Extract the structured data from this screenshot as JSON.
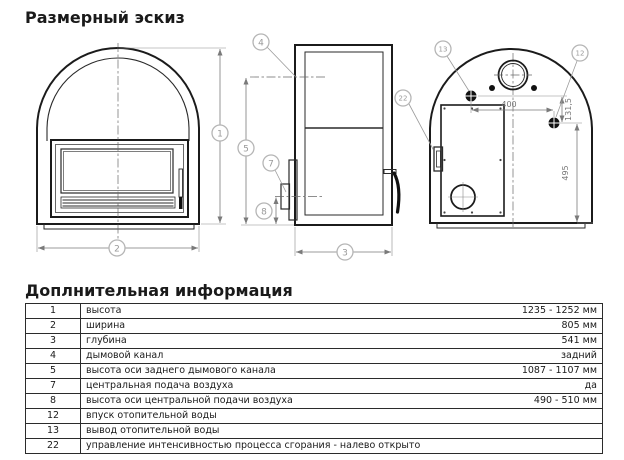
{
  "page": {
    "title": "Размерный эскиз"
  },
  "drawing": {
    "callouts": {
      "c1": "1",
      "c2": "2",
      "c3": "3",
      "c4": "4",
      "c5": "5",
      "c7": "7",
      "c8": "8",
      "c12": "12",
      "c13": "13",
      "c22": "22"
    },
    "dimensions": {
      "rear_horizontal": "400",
      "rear_offset": "131,5",
      "rear_height": "495"
    }
  },
  "info": {
    "heading": "Доплнительная информация",
    "rows": [
      {
        "num": "1",
        "desc": "высота",
        "value": "1235 - 1252 мм"
      },
      {
        "num": "2",
        "desc": "ширина",
        "value": "805 мм"
      },
      {
        "num": "3",
        "desc": "глубина",
        "value": "541 мм"
      },
      {
        "num": "4",
        "desc": "дымовой канал",
        "value": "задний"
      },
      {
        "num": "5",
        "desc": "высота оси заднего дымового канала",
        "value": "1087 - 1107 мм"
      },
      {
        "num": "7",
        "desc": "центральная подача воздуха",
        "value": "да"
      },
      {
        "num": "8",
        "desc": "высота оси центральной подачи воздуха",
        "value": "490 - 510 мм"
      },
      {
        "num": "12",
        "desc": "впуск отопительной воды",
        "value": ""
      },
      {
        "num": "13",
        "desc": "вывод отопительной воды",
        "value": ""
      },
      {
        "num": "22",
        "desc": "управление интенсивностью процесса сгорания - налево открыто",
        "value": ""
      }
    ]
  }
}
